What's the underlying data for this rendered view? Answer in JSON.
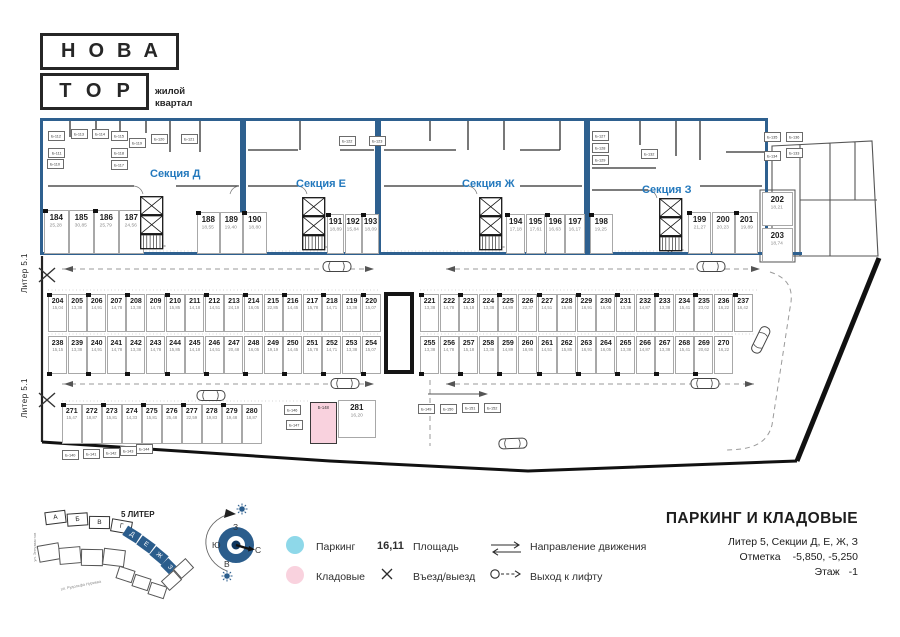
{
  "logo": {
    "top": "НОВА",
    "bottom": "ТОР",
    "tagline1": "жилой",
    "tagline2": "квартал"
  },
  "plan": {
    "liter_edge_label": "Литер 5.1",
    "colors": {
      "section_border": "#2e608f",
      "section_label": "#2479bd"
    },
    "sections": [
      {
        "name": "Секция Д"
      },
      {
        "name": "Секция Е"
      },
      {
        "name": "Секция Ж"
      },
      {
        "name": "Секция З"
      }
    ],
    "groups": {
      "sec_d_left": [
        {
          "n": "184",
          "a": "25,28"
        },
        {
          "n": "185",
          "a": "30,85"
        },
        {
          "n": "186",
          "a": "25,79"
        },
        {
          "n": "187",
          "a": "24,56"
        }
      ],
      "sec_d_right": [
        {
          "n": "188",
          "a": "18,55"
        },
        {
          "n": "189",
          "a": "19,40"
        }
      ],
      "sec_e_190": [
        {
          "n": "190",
          "a": "18,80"
        }
      ],
      "sec_e_right": [
        {
          "n": "191",
          "a": "18,89"
        },
        {
          "n": "192",
          "a": "15,84"
        },
        {
          "n": "193",
          "a": "18,09"
        }
      ],
      "sec_g_right": [
        {
          "n": "194",
          "a": "17,18"
        },
        {
          "n": "195",
          "a": "17,61"
        },
        {
          "n": "196",
          "a": "16,63"
        },
        {
          "n": "197",
          "a": "16,17"
        }
      ],
      "sec_z_198": [
        {
          "n": "198",
          "a": "19,25"
        }
      ],
      "sec_z_right": [
        {
          "n": "199",
          "a": "21,27"
        },
        {
          "n": "200",
          "a": "20,23"
        },
        {
          "n": "201",
          "a": "19,89"
        }
      ],
      "right_stack": [
        {
          "n": "202",
          "a": "18,21"
        },
        {
          "n": "203",
          "a": "18,74"
        }
      ],
      "row1_left": [
        {
          "n": "204",
          "a": "15,04"
        },
        {
          "n": "205",
          "a": "13,38"
        },
        {
          "n": "206",
          "a": "14,91"
        },
        {
          "n": "207",
          "a": "14,78"
        },
        {
          "n": "208",
          "a": "13,38"
        },
        {
          "n": "209",
          "a": "14,78"
        },
        {
          "n": "210",
          "a": "15,85"
        },
        {
          "n": "211",
          "a": "14,18"
        },
        {
          "n": "212",
          "a": "14,51"
        },
        {
          "n": "213",
          "a": "24,19"
        },
        {
          "n": "214",
          "a": "16,05"
        },
        {
          "n": "215",
          "a": "22,85"
        },
        {
          "n": "216",
          "a": "14,45"
        },
        {
          "n": "217",
          "a": "15,78"
        },
        {
          "n": "218",
          "a": "14,71"
        },
        {
          "n": "219",
          "a": "13,38"
        },
        {
          "n": "220",
          "a": "15,07"
        }
      ],
      "row1_right": [
        {
          "n": "221",
          "a": "13,38"
        },
        {
          "n": "222",
          "a": "14,78"
        },
        {
          "n": "223",
          "a": "15,18"
        },
        {
          "n": "224",
          "a": "13,38"
        },
        {
          "n": "225",
          "a": "14,89"
        },
        {
          "n": "226",
          "a": "22,37"
        },
        {
          "n": "227",
          "a": "14,51"
        },
        {
          "n": "228",
          "a": "15,85"
        },
        {
          "n": "229",
          "a": "16,91"
        },
        {
          "n": "230",
          "a": "16,05"
        },
        {
          "n": "231",
          "a": "13,38"
        },
        {
          "n": "232",
          "a": "14,87"
        },
        {
          "n": "233",
          "a": "13,38"
        },
        {
          "n": "234",
          "a": "15,41"
        },
        {
          "n": "235",
          "a": "23,02"
        },
        {
          "n": "236",
          "a": "16,22"
        },
        {
          "n": "237",
          "a": "16,42"
        }
      ],
      "row2_left": [
        {
          "n": "238",
          "a": "15,15"
        },
        {
          "n": "239",
          "a": "13,38"
        },
        {
          "n": "240",
          "a": "14,91"
        },
        {
          "n": "241",
          "a": "14,78"
        },
        {
          "n": "242",
          "a": "13,38"
        },
        {
          "n": "243",
          "a": "14,78"
        },
        {
          "n": "244",
          "a": "15,85"
        },
        {
          "n": "245",
          "a": "14,18"
        },
        {
          "n": "246",
          "a": "14,51"
        },
        {
          "n": "247",
          "a": "20,48"
        },
        {
          "n": "248",
          "a": "16,05"
        },
        {
          "n": "249",
          "a": "19,19"
        },
        {
          "n": "250",
          "a": "14,45"
        },
        {
          "n": "251",
          "a": "15,78"
        },
        {
          "n": "252",
          "a": "14,71"
        },
        {
          "n": "253",
          "a": "13,38"
        },
        {
          "n": "254",
          "a": "15,07"
        }
      ],
      "row2_right": [
        {
          "n": "255",
          "a": "13,38"
        },
        {
          "n": "256",
          "a": "14,78"
        },
        {
          "n": "257",
          "a": "15,18"
        },
        {
          "n": "258",
          "a": "13,38"
        },
        {
          "n": "259",
          "a": "14,89"
        },
        {
          "n": "260",
          "a": "18,95"
        },
        {
          "n": "261",
          "a": "14,51"
        },
        {
          "n": "262",
          "a": "15,85"
        },
        {
          "n": "263",
          "a": "16,91"
        },
        {
          "n": "264",
          "a": "16,05"
        },
        {
          "n": "265",
          "a": "13,38"
        },
        {
          "n": "266",
          "a": "14,87"
        },
        {
          "n": "267",
          "a": "13,38"
        },
        {
          "n": "268",
          "a": "15,41"
        },
        {
          "n": "269",
          "a": "20,62"
        },
        {
          "n": "270",
          "a": "16,22"
        }
      ],
      "row3": [
        {
          "n": "271",
          "a": "15,47"
        },
        {
          "n": "272",
          "a": "18,87"
        },
        {
          "n": "273",
          "a": "15,81"
        },
        {
          "n": "274",
          "a": "14,33"
        },
        {
          "n": "275",
          "a": "15,81"
        },
        {
          "n": "276",
          "a": "25,48"
        },
        {
          "n": "277",
          "a": "22,59"
        },
        {
          "n": "278",
          "a": "19,83"
        },
        {
          "n": "279",
          "a": "19,48"
        },
        {
          "n": "280",
          "a": "18,87"
        }
      ],
      "stall_281": [
        {
          "n": "281",
          "a": "16,20"
        }
      ]
    },
    "storage_labels": [
      {
        "t": "Б-112",
        "x": 48,
        "y": 131
      },
      {
        "t": "Б-113",
        "x": 71,
        "y": 129
      },
      {
        "t": "Б-114",
        "x": 92,
        "y": 129
      },
      {
        "t": "Б-115",
        "x": 111,
        "y": 131
      },
      {
        "t": "Б-111",
        "x": 48,
        "y": 148
      },
      {
        "t": "Б-110",
        "x": 47,
        "y": 159
      },
      {
        "t": "Б-118",
        "x": 111,
        "y": 148
      },
      {
        "t": "Б-117",
        "x": 111,
        "y": 160
      },
      {
        "t": "Б-119",
        "x": 129,
        "y": 138
      },
      {
        "t": "Б-120",
        "x": 151,
        "y": 134
      },
      {
        "t": "Б-121",
        "x": 181,
        "y": 134
      },
      {
        "t": "Б-122",
        "x": 339,
        "y": 136
      },
      {
        "t": "Б-123",
        "x": 369,
        "y": 136
      },
      {
        "t": "Б-127",
        "x": 592,
        "y": 131
      },
      {
        "t": "Б-128",
        "x": 592,
        "y": 143
      },
      {
        "t": "Б-129",
        "x": 592,
        "y": 155
      },
      {
        "t": "Б-132",
        "x": 641,
        "y": 149
      },
      {
        "t": "Б-133",
        "x": 786,
        "y": 148
      },
      {
        "t": "Б-134",
        "x": 764,
        "y": 151
      },
      {
        "t": "Б-135",
        "x": 764,
        "y": 132
      },
      {
        "t": "Б-136",
        "x": 786,
        "y": 132
      },
      {
        "t": "Б-140",
        "x": 62,
        "y": 450
      },
      {
        "t": "Б-141",
        "x": 83,
        "y": 449
      },
      {
        "t": "Б-142",
        "x": 103,
        "y": 448
      },
      {
        "t": "Б-143",
        "x": 120,
        "y": 446
      },
      {
        "t": "Б-144",
        "x": 136,
        "y": 444
      },
      {
        "t": "Б-146",
        "x": 284,
        "y": 405
      },
      {
        "t": "Б-147",
        "x": 286,
        "y": 420
      },
      {
        "t": "Б-149",
        "x": 418,
        "y": 404
      },
      {
        "t": "Б-150",
        "x": 440,
        "y": 404
      },
      {
        "t": "Б-151",
        "x": 462,
        "y": 403
      },
      {
        "t": "Б-152",
        "x": 484,
        "y": 403
      }
    ],
    "storage_highlight": {
      "label": "Б-148"
    }
  },
  "legend": {
    "parking_label": "Паркинг",
    "storage_label": "Кладовые",
    "area_value": "16,11",
    "area_label": "Площадь",
    "entry_label": "Въезд/выезд",
    "direction_label": "Направление движения",
    "lift_label": "Выход к лифту",
    "parking_color": "#8ed8e9",
    "storage_color": "#f9d2de"
  },
  "compass": {
    "top": "З",
    "left": "Ю",
    "right": "С",
    "bottom": "В"
  },
  "site_map": {
    "label": "5 ЛИТЕР",
    "blocks_plain": [
      "А",
      "Б",
      "В",
      "Г"
    ],
    "blocks_highlight": [
      "Д",
      "Е",
      "Ж",
      "З"
    ],
    "street1": "ул. Энтузиастов",
    "street2": "ул. Рудольфа Нуриева",
    "street3": "ул. Мусы Гараева"
  },
  "title_block": {
    "title": "ПАРКИНГ И КЛАДОВЫЕ",
    "line1": "Литер 5, Секции Д, Е, Ж, З",
    "mark_label": "Отметка",
    "mark_value": "-5,850, -5,250",
    "floor_label": "Этаж",
    "floor_value": "-1"
  }
}
